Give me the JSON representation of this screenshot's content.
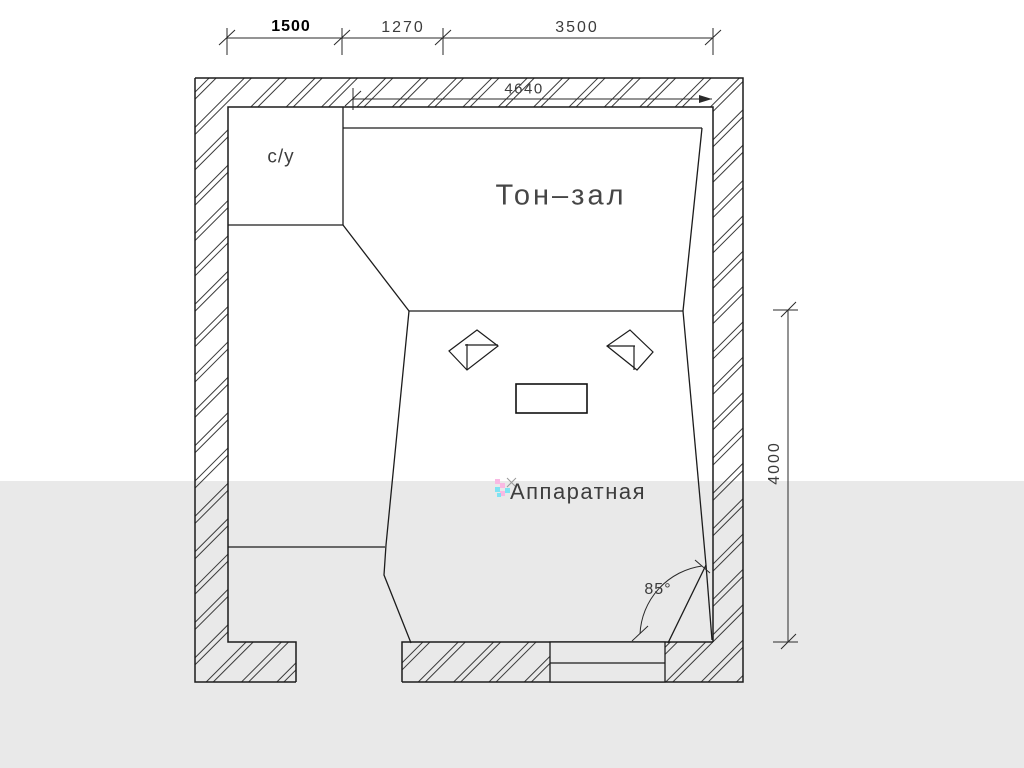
{
  "plan": {
    "rooms": {
      "tone_hall": "Тон–зал",
      "control_room": "Аппаратная",
      "wc": "с/у"
    },
    "dims": {
      "top_chain": [
        "1500",
        "1270",
        "3500"
      ],
      "inner_width": "4640",
      "right_height": "4000",
      "corner_angle": "85°"
    },
    "colors": {
      "background": "#ffffff",
      "lower_band": "#e9e9e9",
      "wall_line": "#1c1c1c",
      "hatch_line": "#3a3a3a",
      "artifact_cyan": "#7fe3f3",
      "artifact_pink": "#f9b9e3"
    }
  }
}
